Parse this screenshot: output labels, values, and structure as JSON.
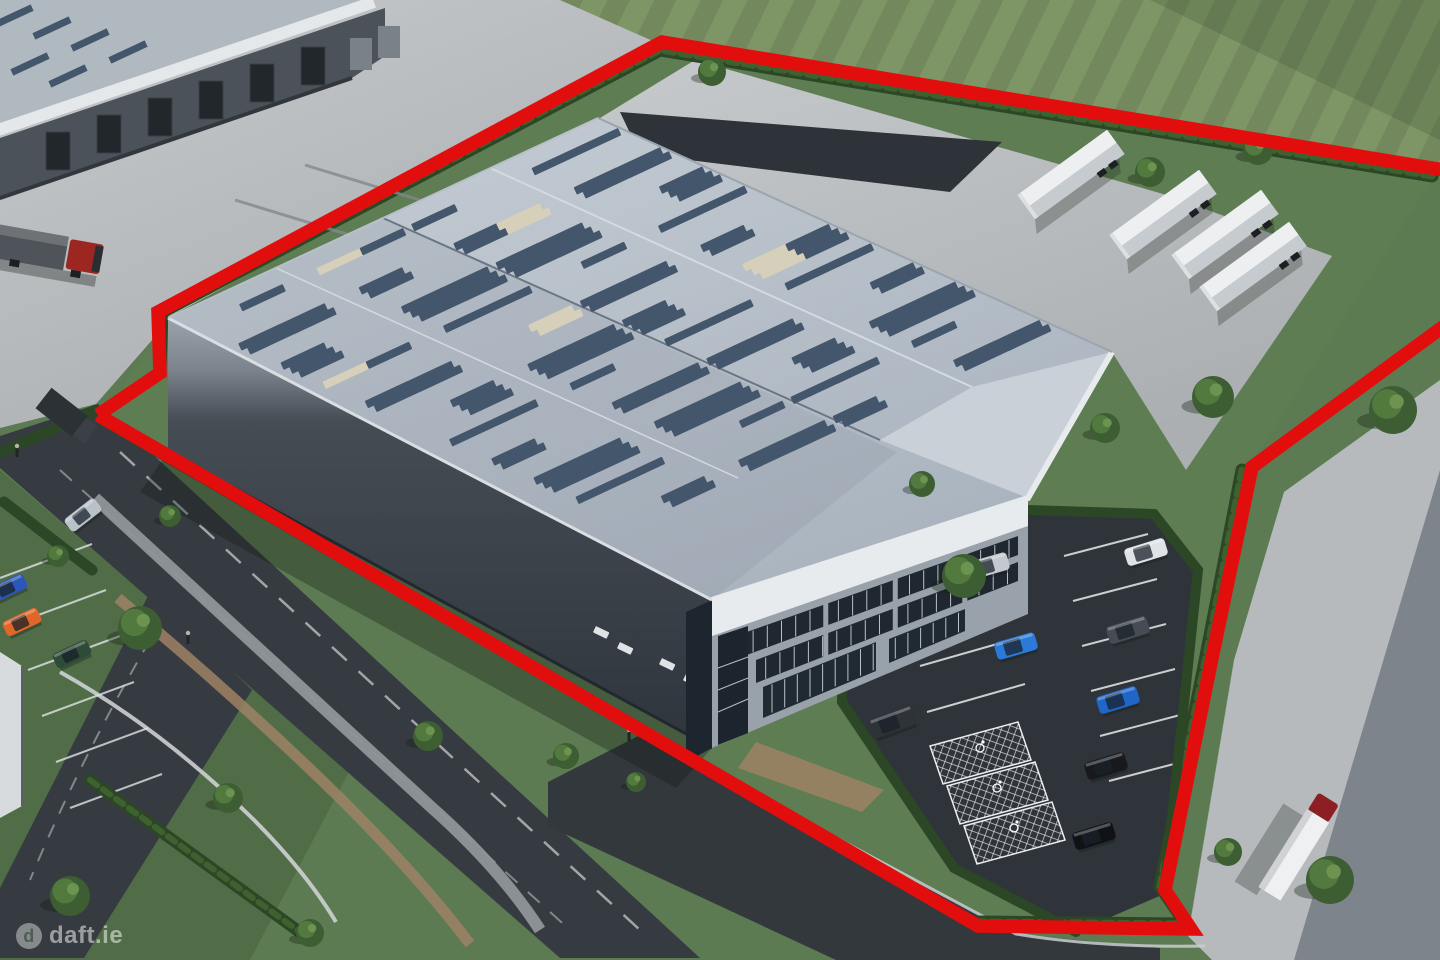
{
  "image_type": "aerial-3d-property-render",
  "watermark": {
    "logo_letter": "d",
    "text": "daft.ie"
  },
  "palette": {
    "boundary_red": "#e20d0d",
    "grass": "#5d7b52",
    "field_grass": "#7e9566",
    "hedge_green": "#2c4726",
    "hedge_light": "#3f6130",
    "concrete": "#bcc0c2",
    "asphalt": "#363b41",
    "roof_light": "#b6c0ca",
    "skylight_dark": "#44566b",
    "skylight_cream": "#d6cfba",
    "wall_dark": "#3c434b",
    "wall_office": "#99a1aa",
    "fascia_white": "#e8ebed",
    "glass_dark": "#1f2731",
    "kerb_white": "#ccd0d2"
  },
  "scene": {
    "site_boundary": "red-outline",
    "main_building": "warehouse-with-office-corner",
    "neighbour_building": "warehouse-with-loading-docks",
    "parking": {
      "disabled_bays": 3
    }
  },
  "vehicles": {
    "yard_trailers": {
      "count": 4,
      "color": "#edeff1"
    },
    "trucks": [
      {
        "name": "truck-red-cab-top-left",
        "cab": "#9c2622",
        "trailer": "#4f545a"
      },
      {
        "name": "truck-white-trailer-bottom-right",
        "cab": "#8c1f23",
        "trailer": "#eef0f2"
      },
      {
        "name": "box-truck-left-road",
        "body": "#2c3136"
      }
    ],
    "parking_cars": [
      {
        "color": "#c3c9cf"
      },
      {
        "color": "#dfe3e6"
      },
      {
        "color": "#2b79d8"
      },
      {
        "color": "#454c54"
      },
      {
        "color": "#1f66c8"
      },
      {
        "color": "#17191c"
      },
      {
        "color": "#101215"
      },
      {
        "color": "#2e3338"
      }
    ],
    "road_cars": [
      {
        "color": "#b9c2c9"
      },
      {
        "color": "#2b58b8"
      },
      {
        "color": "#e0662a"
      },
      {
        "color": "#2e4a38"
      }
    ]
  }
}
